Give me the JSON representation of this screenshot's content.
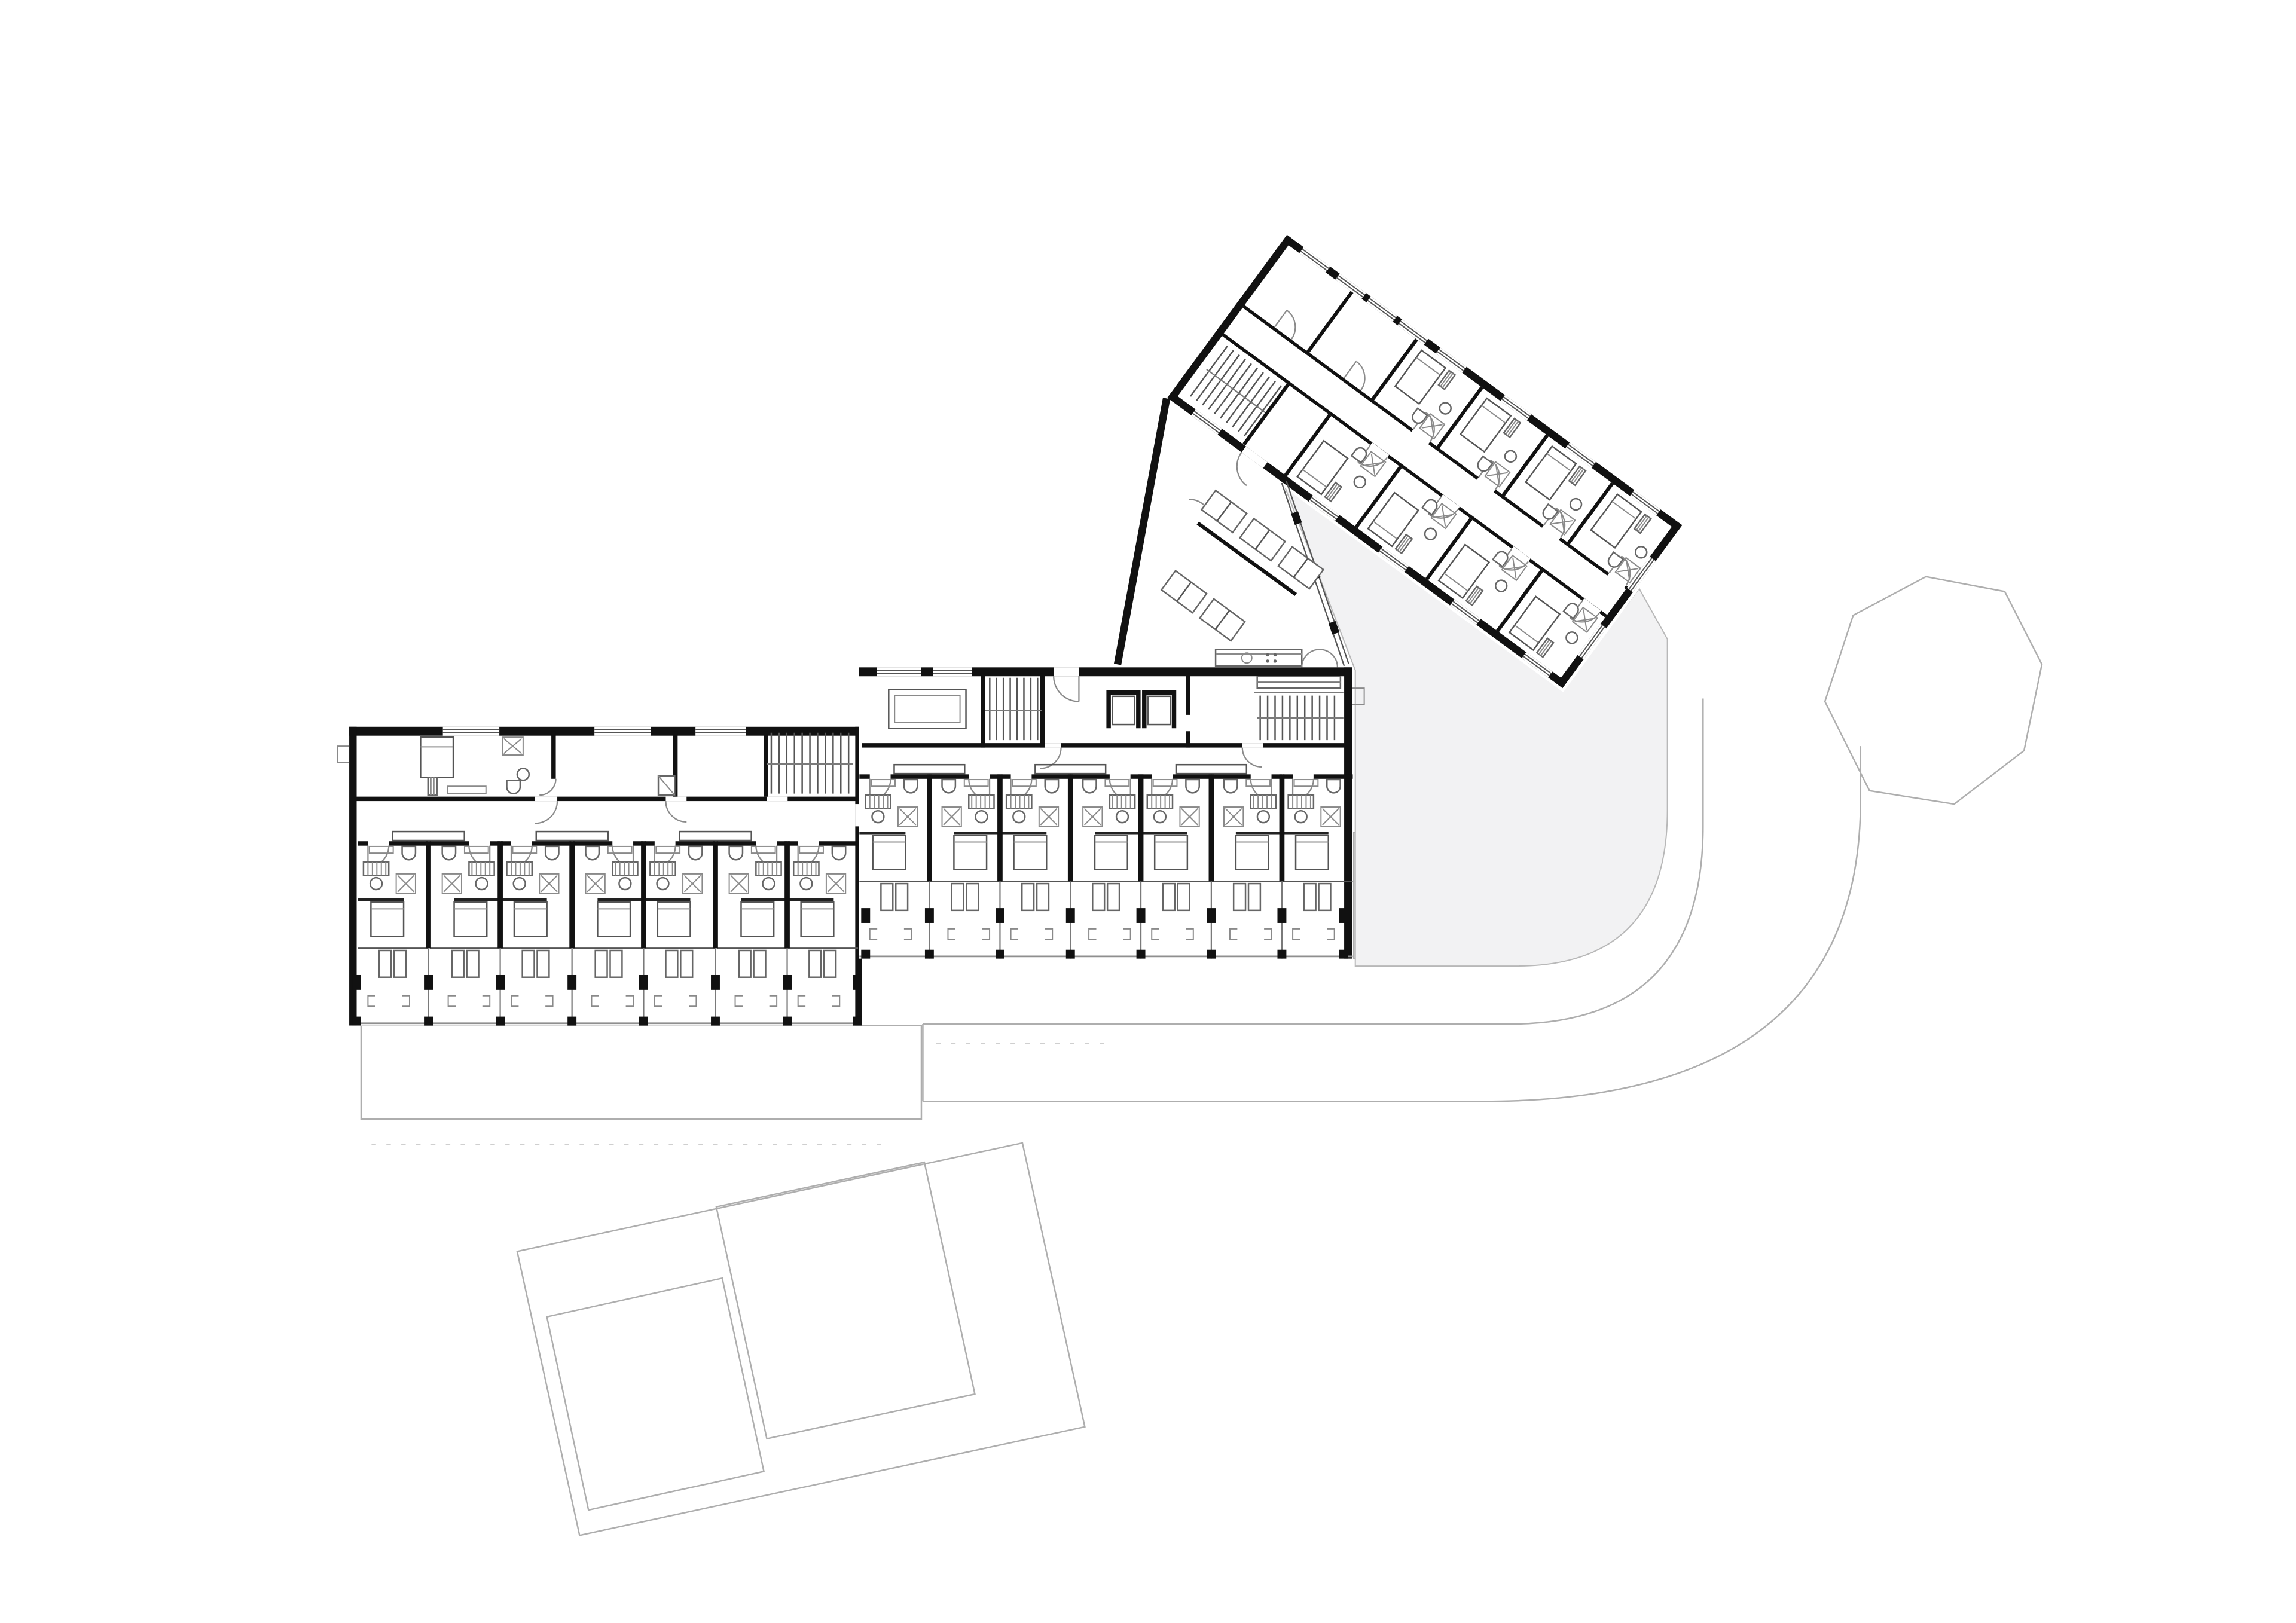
{
  "document": {
    "kind": "architectural-floor-plan",
    "view": "upper floor plan of an angled hotel / hostel building with site context",
    "visible_text_labels": "none"
  },
  "palette": {
    "paper": "#ffffff",
    "wall": "#111111",
    "interior_line": "#555555",
    "furniture_line": "#777777",
    "site_line": "#aeaeae",
    "site_fill": "#f1f1f2",
    "courtyard_fill": "#f2f2f3"
  },
  "wings": {
    "west": {
      "guest_rooms": 7,
      "balconies": 7,
      "core_rooms": [
        "staff-apartment-with-bath",
        "store-room",
        "straight-stair"
      ],
      "room_features": [
        "entry-door-swing",
        "wc",
        "vanity-shelf",
        "washbasin",
        "shower",
        "bed",
        "balcony-doors",
        "balcony-chairs",
        "railing"
      ]
    },
    "center": {
      "guest_rooms": 7,
      "balconies": 7,
      "core_rooms": [
        "meeting-room-with-table",
        "straight-stair",
        "two-elevators",
        "entrance-vestibule",
        "main-stair-with-counter"
      ],
      "elevator_count": 2
    },
    "north_rotated": {
      "rotation_degrees": 36.3,
      "guest_rooms_upper_row": 4,
      "guest_rooms_lower_row": 4,
      "unfurnished_rooms": 2,
      "internal_stair": 1,
      "central_corridor": true
    }
  },
  "connector_hall": {
    "lounge_rooms": 2,
    "table_pairs": 5,
    "kitchenette_counter": 1,
    "kitchenette_fixtures": [
      "sink-circle",
      "cooktop-4-dots"
    ],
    "glazed_wall_to_courtyard": true,
    "double_entrance_door": true
  },
  "site": {
    "courtyard_areas": 1,
    "access_path_curved": true,
    "neighbor_buildings": 2,
    "terrace_outlines": 2
  },
  "icons": {
    "bed-icon": "rectangle with pillow line",
    "shower-icon": "square with diagonal X",
    "washbasin-icon": "small circle",
    "toilet-icon": "U shape on wall",
    "wardrobe-icon": "hatched rectangle",
    "stair-icon": "row of parallel treads",
    "elevator-icon": "square in black U frame",
    "door-icon": "quarter-circle swing",
    "chair-icon": "small bracket glyph",
    "table-icon": "paired rectangles",
    "window-icon": "double line in wall gap"
  }
}
